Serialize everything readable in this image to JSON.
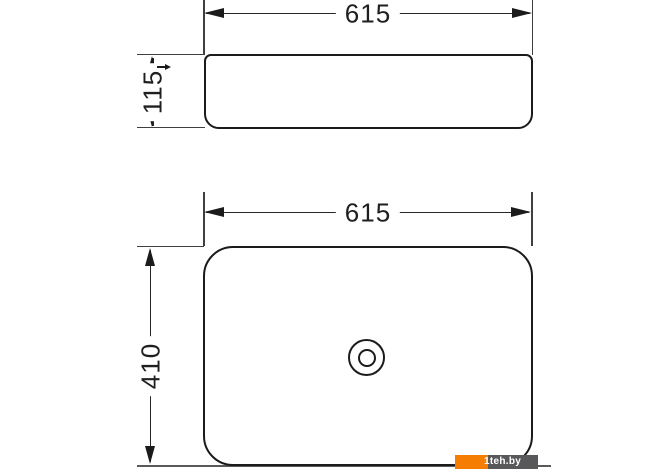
{
  "drawing": {
    "line_color": "#1b1b1b",
    "side_view": {
      "width_dim": "615",
      "height_dim": "115"
    },
    "plan_view": {
      "width_dim": "615",
      "height_dim": "410"
    }
  },
  "watermark": {
    "label": "1teh.by",
    "accent_color": "#f57d01",
    "badge_color": "#58585a"
  }
}
